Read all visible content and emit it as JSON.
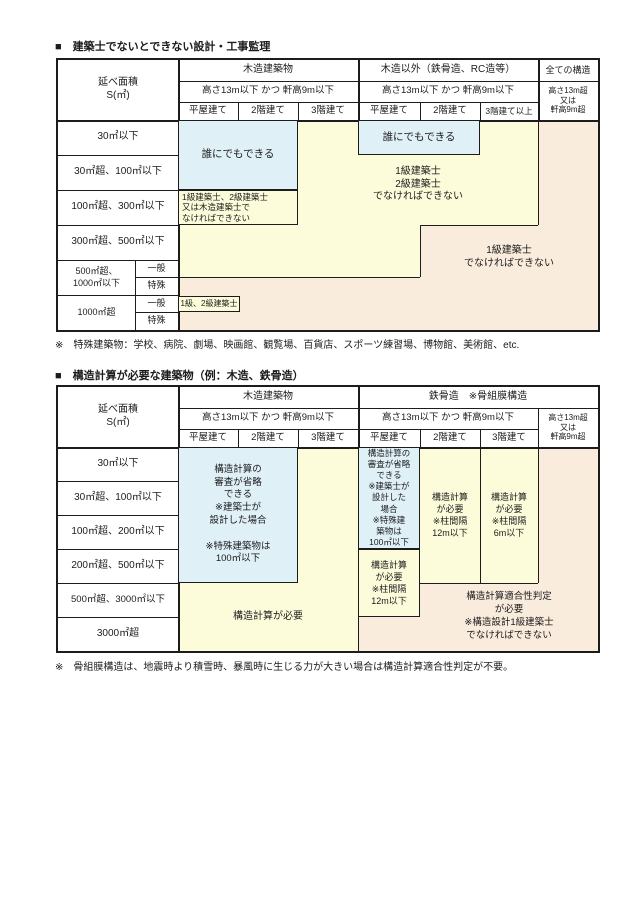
{
  "colors": {
    "zone_blue": "#dff0f7",
    "zone_yellow": "#fcfcdb",
    "zone_orange": "#faecdd"
  },
  "table1": {
    "title": "■　建築士でないとできない設計・工事監理",
    "header": {
      "area": "延べ面積\nS(㎡)",
      "wood_group": "木造建築物",
      "nonwood_group": "木造以外（鉄骨造、RC造等）",
      "all_group": "全ての構造",
      "wood_condition": "高さ13m以下 かつ 軒高9m以下",
      "nonwood_condition": "高さ13m以下 かつ 軒高9m以下",
      "tall_condition": "高さ13m超\n又は\n軒高9m超",
      "storeys": [
        "平屋建て",
        "2階建て",
        "3階建て",
        "平屋建て",
        "2階建て",
        "3階建て以上"
      ]
    },
    "rows": [
      "30㎡以下",
      "30㎡超、100㎡以下",
      "100㎡超、300㎡以下",
      "300㎡超、500㎡以下",
      "500㎡超、\n1000㎡以下",
      "1000㎡超"
    ],
    "sub_rows": {
      "general": "一般",
      "special": "特殊"
    },
    "zones": {
      "anyone_wood": "誰にでもできる",
      "anyone_nonwood": "誰にでもできる",
      "wood_small_box": "1級建築士、2級建築士\n又は木造建築士で\nなければできない",
      "class12": "1級建築士\n2級建築士\nでなければできない",
      "class1": "1級建築士\nでなければできない",
      "box_over1000": "1級、2級建築士"
    },
    "note": "※　特殊建築物：学校、病院、劇場、映画館、観覧場、百貨店、スポーツ練習場、博物館、美術館、etc."
  },
  "table2": {
    "title": "■　構造計算が必要な建築物（例：木造、鉄骨造）",
    "header": {
      "area": "延べ面積\nS(㎡)",
      "wood_group": "木造建築物",
      "steel_group": "鉄骨造　※骨組膜構造",
      "wood_condition": "高さ13m以下 かつ 軒高9m以下",
      "steel_condition": "高さ13m以下 かつ 軒高9m以下",
      "tall_condition": "高さ13m超\n又は\n軒高9m超",
      "storeys": [
        "平屋建て",
        "2階建て",
        "3階建て",
        "平屋建て",
        "2階建て",
        "3階建て"
      ]
    },
    "rows": [
      "30㎡以下",
      "30㎡超、100㎡以下",
      "100㎡超、200㎡以下",
      "200㎡超、500㎡以下",
      "500㎡超、3000㎡以下",
      "3000㎡超"
    ],
    "zones": {
      "wood_skip": "構造計算の\n審査が省略\nできる\n※建築士が\n設計した場合\n\n※特殊建築物は\n100㎡以下",
      "wood_required": "構造計算が必要",
      "steel_skip": "構造計算の\n審査が省略\nできる\n※建築士が\n設計した\n場合\n※特殊建\n築物は\n100㎡以下",
      "steel_1f": "構造計算\nが必要\n※柱間隔\n12m以下",
      "steel_2f": "構造計算\nが必要\n※柱間隔\n12m以下",
      "steel_3f": "構造計算\nが必要\n※柱間隔\n6m以下",
      "judgement": "構造計算適合性判定\nが必要\n※構造設計1級建築士\nでなければできない"
    },
    "note": "※　骨組膜構造は、地震時より積雪時、暴風時に生じる力が大きい場合は構造計算適合性判定が不要。"
  }
}
